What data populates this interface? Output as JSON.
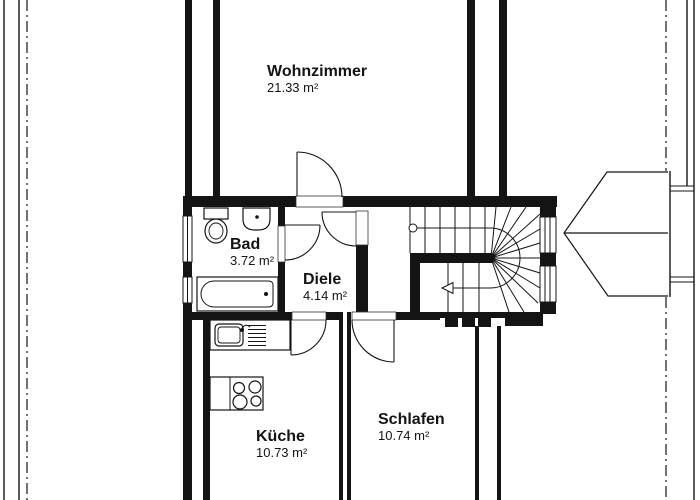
{
  "plan": {
    "type": "floor-plan",
    "background": "#ffffff",
    "line_color": "#141414",
    "rooms": [
      {
        "key": "wohnzimmer",
        "name": "Wohnzimmer",
        "area": "21.33 m²"
      },
      {
        "key": "bad",
        "name": "Bad",
        "area": "3.72 m²"
      },
      {
        "key": "diele",
        "name": "Diele",
        "area": "4.14 m²"
      },
      {
        "key": "kueche",
        "name": "Küche",
        "area": "10.73 m²"
      },
      {
        "key": "schlafen",
        "name": "Schlafen",
        "area": "10.74 m²"
      }
    ],
    "fixtures": [
      "toilet",
      "washbasin",
      "bathtub",
      "kitchen-sink",
      "stove-hob",
      "winder-staircase",
      "stair-walk-line",
      "stair-direction-arrow",
      "railing-posts",
      "window-symbols",
      "door-swings",
      "roof-outline-arrow"
    ]
  }
}
